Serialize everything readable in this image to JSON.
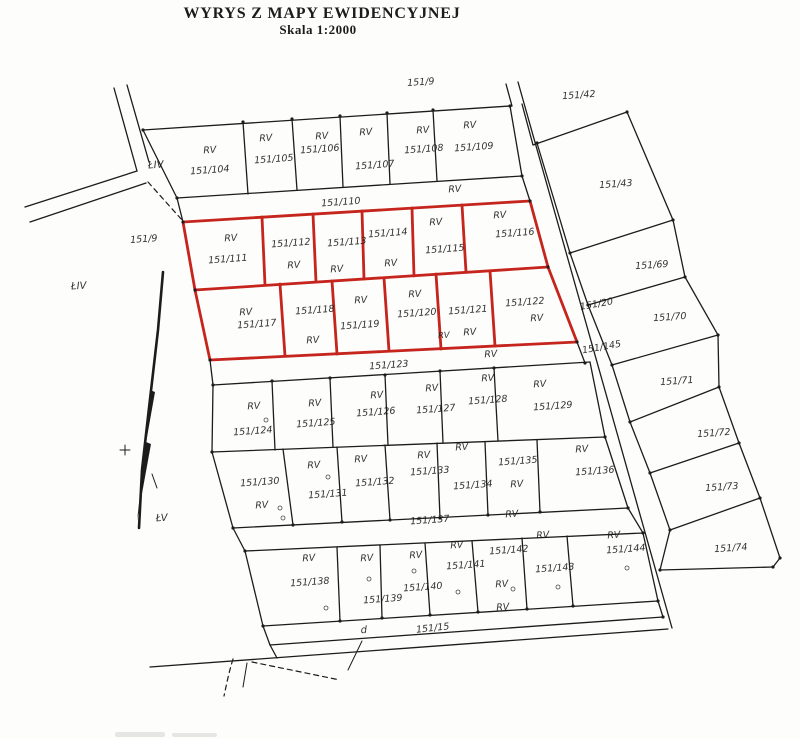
{
  "title": "WYRYS Z MAPY EWIDENCYJNEJ",
  "scale_label": "Skala  1:2000",
  "colors": {
    "ink": "#1c1c1c",
    "highlight": "#c5251d",
    "paper": "#fdfdfc"
  },
  "map": {
    "highlighted_parcels": [
      "151/111",
      "151/112",
      "151/113",
      "151/114",
      "151/115",
      "151/116",
      "151/117",
      "151/118",
      "151/119",
      "151/120",
      "151/121",
      "151/122"
    ],
    "labels": [
      {
        "t": "151/9",
        "x": 421,
        "y": 85
      },
      {
        "t": "151/42",
        "x": 579,
        "y": 98
      },
      {
        "t": "RV",
        "x": 210,
        "y": 153
      },
      {
        "t": "151/104",
        "x": 210,
        "y": 173
      },
      {
        "t": "RV",
        "x": 266,
        "y": 141
      },
      {
        "t": "151/105",
        "x": 274,
        "y": 162
      },
      {
        "t": "RV",
        "x": 322,
        "y": 139
      },
      {
        "t": "151/106",
        "x": 320,
        "y": 152
      },
      {
        "t": "RV",
        "x": 366,
        "y": 135
      },
      {
        "t": "151/107",
        "x": 375,
        "y": 168
      },
      {
        "t": "RV",
        "x": 423,
        "y": 133
      },
      {
        "t": "151/108",
        "x": 424,
        "y": 152
      },
      {
        "t": "RV",
        "x": 470,
        "y": 128
      },
      {
        "t": "151/109",
        "x": 474,
        "y": 150
      },
      {
        "t": "RV",
        "x": 455,
        "y": 192
      },
      {
        "t": "151/110",
        "x": 341,
        "y": 205
      },
      {
        "t": "ŁIV",
        "x": 156,
        "y": 168,
        "s": 10
      },
      {
        "t": "151/9",
        "x": 144,
        "y": 242
      },
      {
        "t": "ŁIV",
        "x": 79,
        "y": 289,
        "s": 10
      },
      {
        "t": "ŁV",
        "x": 162,
        "y": 521,
        "s": 10
      },
      {
        "t": "RV",
        "x": 231,
        "y": 241
      },
      {
        "t": "151/111",
        "x": 228,
        "y": 262
      },
      {
        "t": "151/112",
        "x": 291,
        "y": 246
      },
      {
        "t": "RV",
        "x": 294,
        "y": 268
      },
      {
        "t": "151/113",
        "x": 347,
        "y": 245
      },
      {
        "t": "RV",
        "x": 337,
        "y": 272
      },
      {
        "t": "151/114",
        "x": 388,
        "y": 236
      },
      {
        "t": "RV",
        "x": 391,
        "y": 266
      },
      {
        "t": "RV",
        "x": 436,
        "y": 225
      },
      {
        "t": "151/115",
        "x": 445,
        "y": 252
      },
      {
        "t": "RV",
        "x": 500,
        "y": 218
      },
      {
        "t": "151/116",
        "x": 515,
        "y": 236
      },
      {
        "t": "RV",
        "x": 246,
        "y": 315
      },
      {
        "t": "151/117",
        "x": 257,
        "y": 327
      },
      {
        "t": "151/118",
        "x": 315,
        "y": 313
      },
      {
        "t": "RV",
        "x": 313,
        "y": 343
      },
      {
        "t": "RV",
        "x": 361,
        "y": 303
      },
      {
        "t": "151/119",
        "x": 360,
        "y": 328
      },
      {
        "t": "RV",
        "x": 415,
        "y": 297
      },
      {
        "t": "151/120",
        "x": 417,
        "y": 316
      },
      {
        "t": "151/121",
        "x": 468,
        "y": 313
      },
      {
        "t": "RV",
        "x": 444,
        "y": 338,
        "s": 8.5
      },
      {
        "t": "RV",
        "x": 470,
        "y": 335
      },
      {
        "t": "151/122",
        "x": 525,
        "y": 305
      },
      {
        "t": "RV",
        "x": 537,
        "y": 321
      },
      {
        "t": "151/20",
        "x": 597,
        "y": 307,
        "r": -10
      },
      {
        "t": "151/145",
        "x": 602,
        "y": 350,
        "r": -10
      },
      {
        "t": "151/43",
        "x": 616,
        "y": 187
      },
      {
        "t": "151/69",
        "x": 652,
        "y": 268
      },
      {
        "t": "151/70",
        "x": 670,
        "y": 320
      },
      {
        "t": "151/71",
        "x": 677,
        "y": 384
      },
      {
        "t": "151/72",
        "x": 714,
        "y": 436
      },
      {
        "t": "151/73",
        "x": 722,
        "y": 490
      },
      {
        "t": "151/74",
        "x": 731,
        "y": 551
      },
      {
        "t": "151/123",
        "x": 389,
        "y": 368
      },
      {
        "t": "RV",
        "x": 491,
        "y": 357
      },
      {
        "t": "RV",
        "x": 254,
        "y": 409
      },
      {
        "t": "151/124",
        "x": 253,
        "y": 434
      },
      {
        "t": "RV",
        "x": 315,
        "y": 406
      },
      {
        "t": "151/125",
        "x": 316,
        "y": 426
      },
      {
        "t": "RV",
        "x": 377,
        "y": 398
      },
      {
        "t": "151/126",
        "x": 376,
        "y": 415
      },
      {
        "t": "RV",
        "x": 432,
        "y": 391
      },
      {
        "t": "151/127",
        "x": 436,
        "y": 412
      },
      {
        "t": "RV",
        "x": 488,
        "y": 381
      },
      {
        "t": "151/128",
        "x": 488,
        "y": 403
      },
      {
        "t": "RV",
        "x": 540,
        "y": 387
      },
      {
        "t": "151/129",
        "x": 553,
        "y": 409
      },
      {
        "t": "151/130",
        "x": 260,
        "y": 485
      },
      {
        "t": "RV",
        "x": 262,
        "y": 508
      },
      {
        "t": "RV",
        "x": 314,
        "y": 468
      },
      {
        "t": "151/131",
        "x": 328,
        "y": 497
      },
      {
        "t": "RV",
        "x": 361,
        "y": 462
      },
      {
        "t": "151/132",
        "x": 375,
        "y": 485
      },
      {
        "t": "RV",
        "x": 424,
        "y": 458
      },
      {
        "t": "151/133",
        "x": 430,
        "y": 474
      },
      {
        "t": "RV",
        "x": 462,
        "y": 450
      },
      {
        "t": "151/134",
        "x": 473,
        "y": 488
      },
      {
        "t": "RV",
        "x": 517,
        "y": 487
      },
      {
        "t": "151/135",
        "x": 518,
        "y": 464
      },
      {
        "t": "RV",
        "x": 582,
        "y": 452
      },
      {
        "t": "151/136",
        "x": 595,
        "y": 474
      },
      {
        "t": "151/137",
        "x": 430,
        "y": 523
      },
      {
        "t": "RV",
        "x": 512,
        "y": 517
      },
      {
        "t": "RV",
        "x": 309,
        "y": 561
      },
      {
        "t": "151/138",
        "x": 310,
        "y": 585
      },
      {
        "t": "RV",
        "x": 367,
        "y": 561
      },
      {
        "t": "151/139",
        "x": 383,
        "y": 602
      },
      {
        "t": "RV",
        "x": 416,
        "y": 558
      },
      {
        "t": "151/140",
        "x": 423,
        "y": 590
      },
      {
        "t": "RV",
        "x": 457,
        "y": 548
      },
      {
        "t": "151/141",
        "x": 466,
        "y": 568
      },
      {
        "t": "151/142",
        "x": 509,
        "y": 553
      },
      {
        "t": "RV",
        "x": 502,
        "y": 587
      },
      {
        "t": "RV",
        "x": 543,
        "y": 538
      },
      {
        "t": "151/143",
        "x": 555,
        "y": 571
      },
      {
        "t": "RV",
        "x": 614,
        "y": 538
      },
      {
        "t": "151/144",
        "x": 626,
        "y": 552
      },
      {
        "t": "RV",
        "x": 503,
        "y": 610
      },
      {
        "t": "d",
        "x": 364,
        "y": 633,
        "s": 10
      },
      {
        "t": "151/15",
        "x": 433,
        "y": 631,
        "r": -6
      }
    ]
  }
}
